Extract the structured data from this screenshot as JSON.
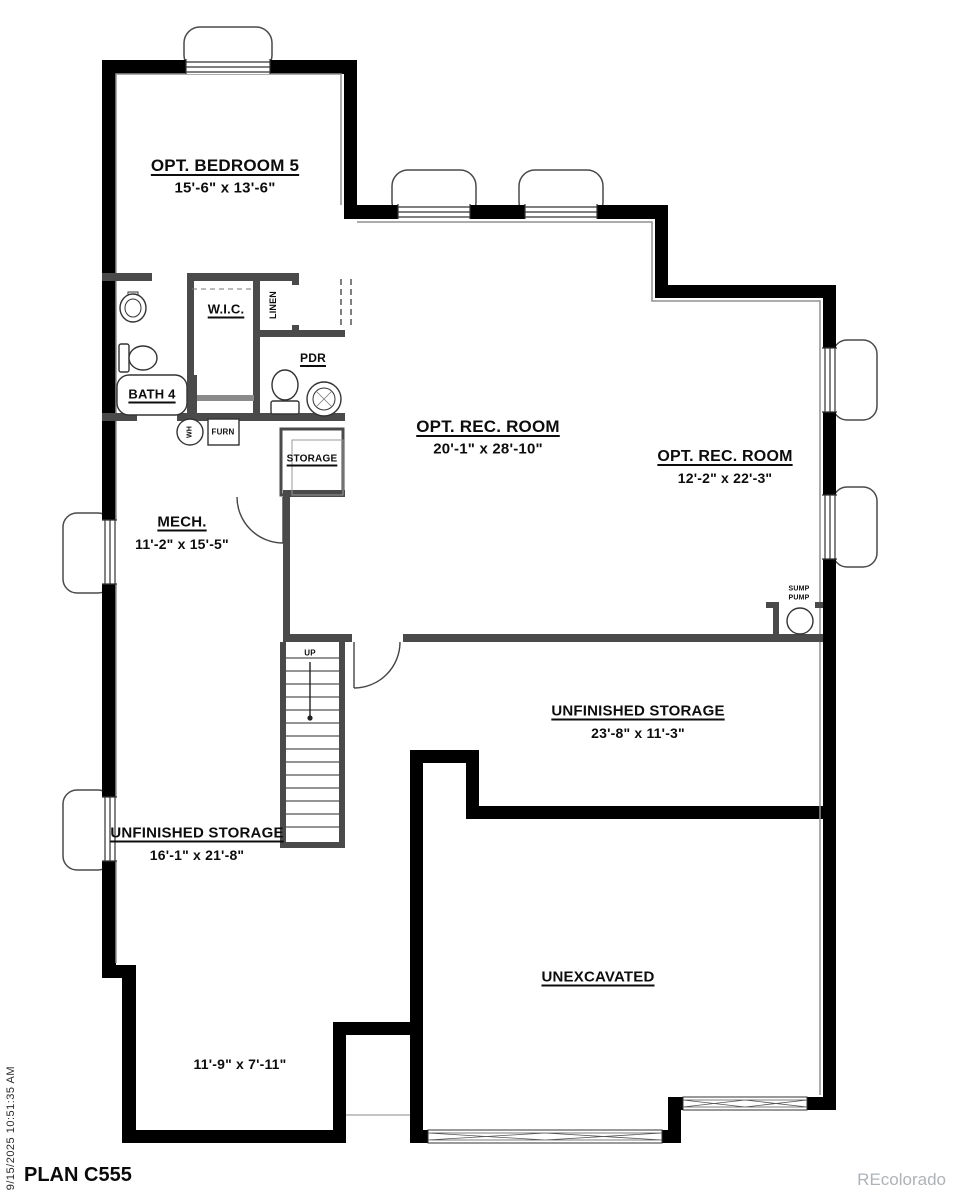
{
  "plan": {
    "title": "PLAN C555",
    "printed_timestamp": "9/15/2025 10:51:35 AM",
    "watermark": "REcolorado"
  },
  "labels": {
    "bedroom": {
      "name": "OPT. BEDROOM 5",
      "dims": "15'-6\" x 13'-6\""
    },
    "wic": {
      "name": "W.I.C."
    },
    "linen": {
      "name": "LINEN"
    },
    "pdr": {
      "name": "PDR"
    },
    "bath": {
      "name": "BATH 4"
    },
    "water_heater": {
      "name": "WH"
    },
    "furnace": {
      "name": "FURN"
    },
    "storage_closet": {
      "name": "STORAGE"
    },
    "mech": {
      "name": "MECH.",
      "dims": "11'-2\" x 15'-5\""
    },
    "rec_main": {
      "name": "OPT. REC. ROOM",
      "dims": "20'-1\" x 28'-10\""
    },
    "rec_side": {
      "name": "OPT. REC. ROOM",
      "dims": "12'-2\" x 22'-3\""
    },
    "sump": {
      "name": "SUMP PUMP"
    },
    "stairs": {
      "name": "UP"
    },
    "storage_right": {
      "name": "UNFINISHED STORAGE",
      "dims": "23'-8\" x 11'-3\""
    },
    "storage_left": {
      "name": "UNFINISHED STORAGE",
      "dims": "16'-1\" x 21'-8\""
    },
    "unexcavated": {
      "name": "UNEXCAVATED"
    },
    "crawl": {
      "dims": "11'-9\" x 7'-11\""
    }
  },
  "colors": {
    "exterior_wall": "#000000",
    "interior_wall": "#4a4a4a",
    "inner_face_line": "#909090",
    "watermark_gray": "#aeb3b7",
    "paper": "#ffffff"
  }
}
